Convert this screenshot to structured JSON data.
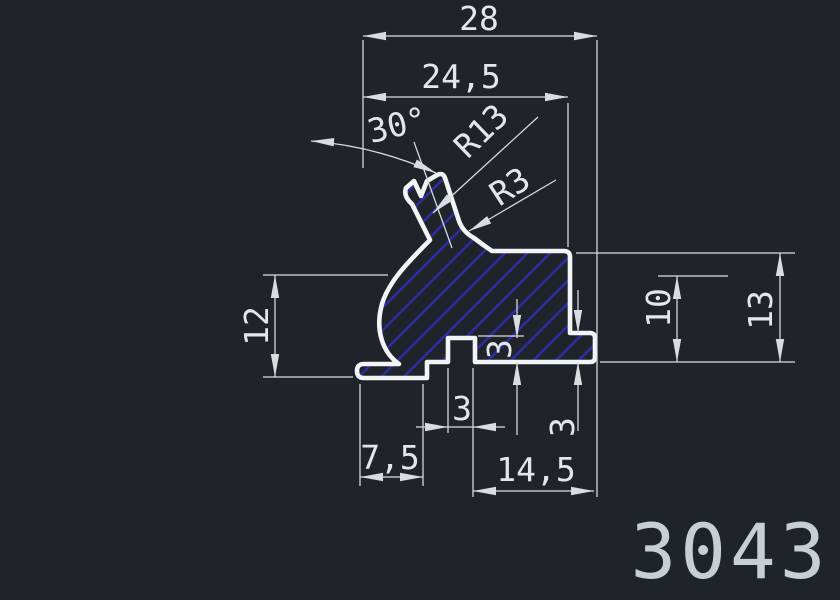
{
  "title": {
    "part_number": "3043"
  },
  "dimensions": {
    "overall_width": "28",
    "upper_width": "24,5",
    "angle": "30°",
    "radius_large": "R13",
    "radius_small": "R3",
    "left_height": "12",
    "right_step_height": "10",
    "right_height": "13",
    "step_depth": "3",
    "flange_height": "3",
    "slot_width": "3",
    "foot_length": "7,5",
    "bottom_length": "14,5"
  },
  "colors": {
    "background": "#20242a",
    "outline": "#f2f4f5",
    "lines": "#d9dde0",
    "hatch": "#2d2da8",
    "dim_text": "#e3e7e9",
    "title_text": "#c9ced2"
  }
}
